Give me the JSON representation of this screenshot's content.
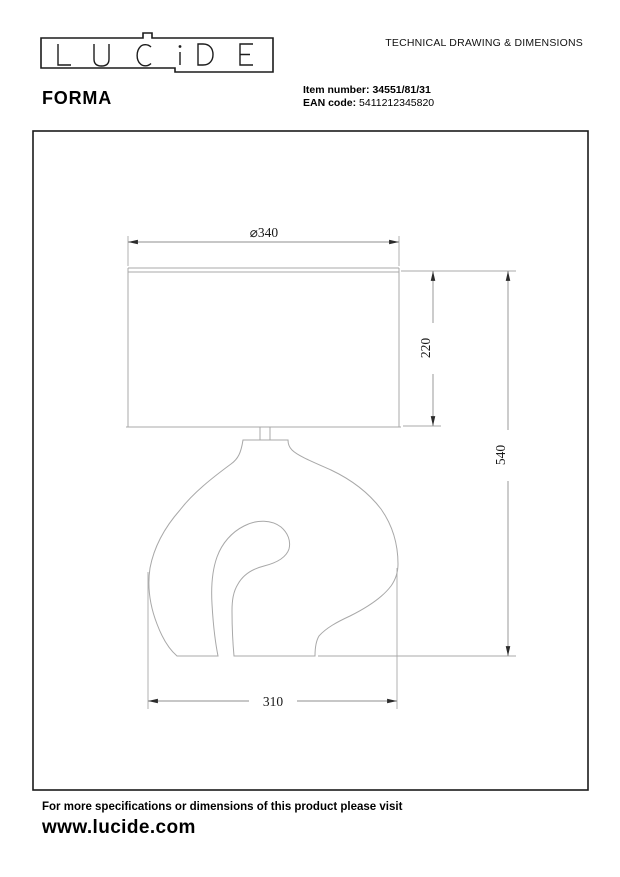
{
  "header": {
    "logo_text": "LUCIDE",
    "doc_title": "TECHNICAL DRAWING & DIMENSIONS",
    "product_name": "FORMA",
    "item_number_label": "Item number:",
    "item_number_value": "34551/81/31",
    "ean_label": "EAN code:",
    "ean_value": "5411212345820"
  },
  "drawing": {
    "dimensions": {
      "shade_diameter": "⌀340",
      "shade_height": "220",
      "total_height": "540",
      "base_width": "310"
    }
  },
  "footer": {
    "note": "For more specifications or dimensions of this product please visit",
    "website": "www.lucide.com"
  },
  "colors": {
    "frame": "#1a1a1a",
    "lamp-line": "#a8a8a8",
    "dim-line": "#8f8f8f",
    "arrow": "#2b2b2b",
    "text": "#000000"
  }
}
